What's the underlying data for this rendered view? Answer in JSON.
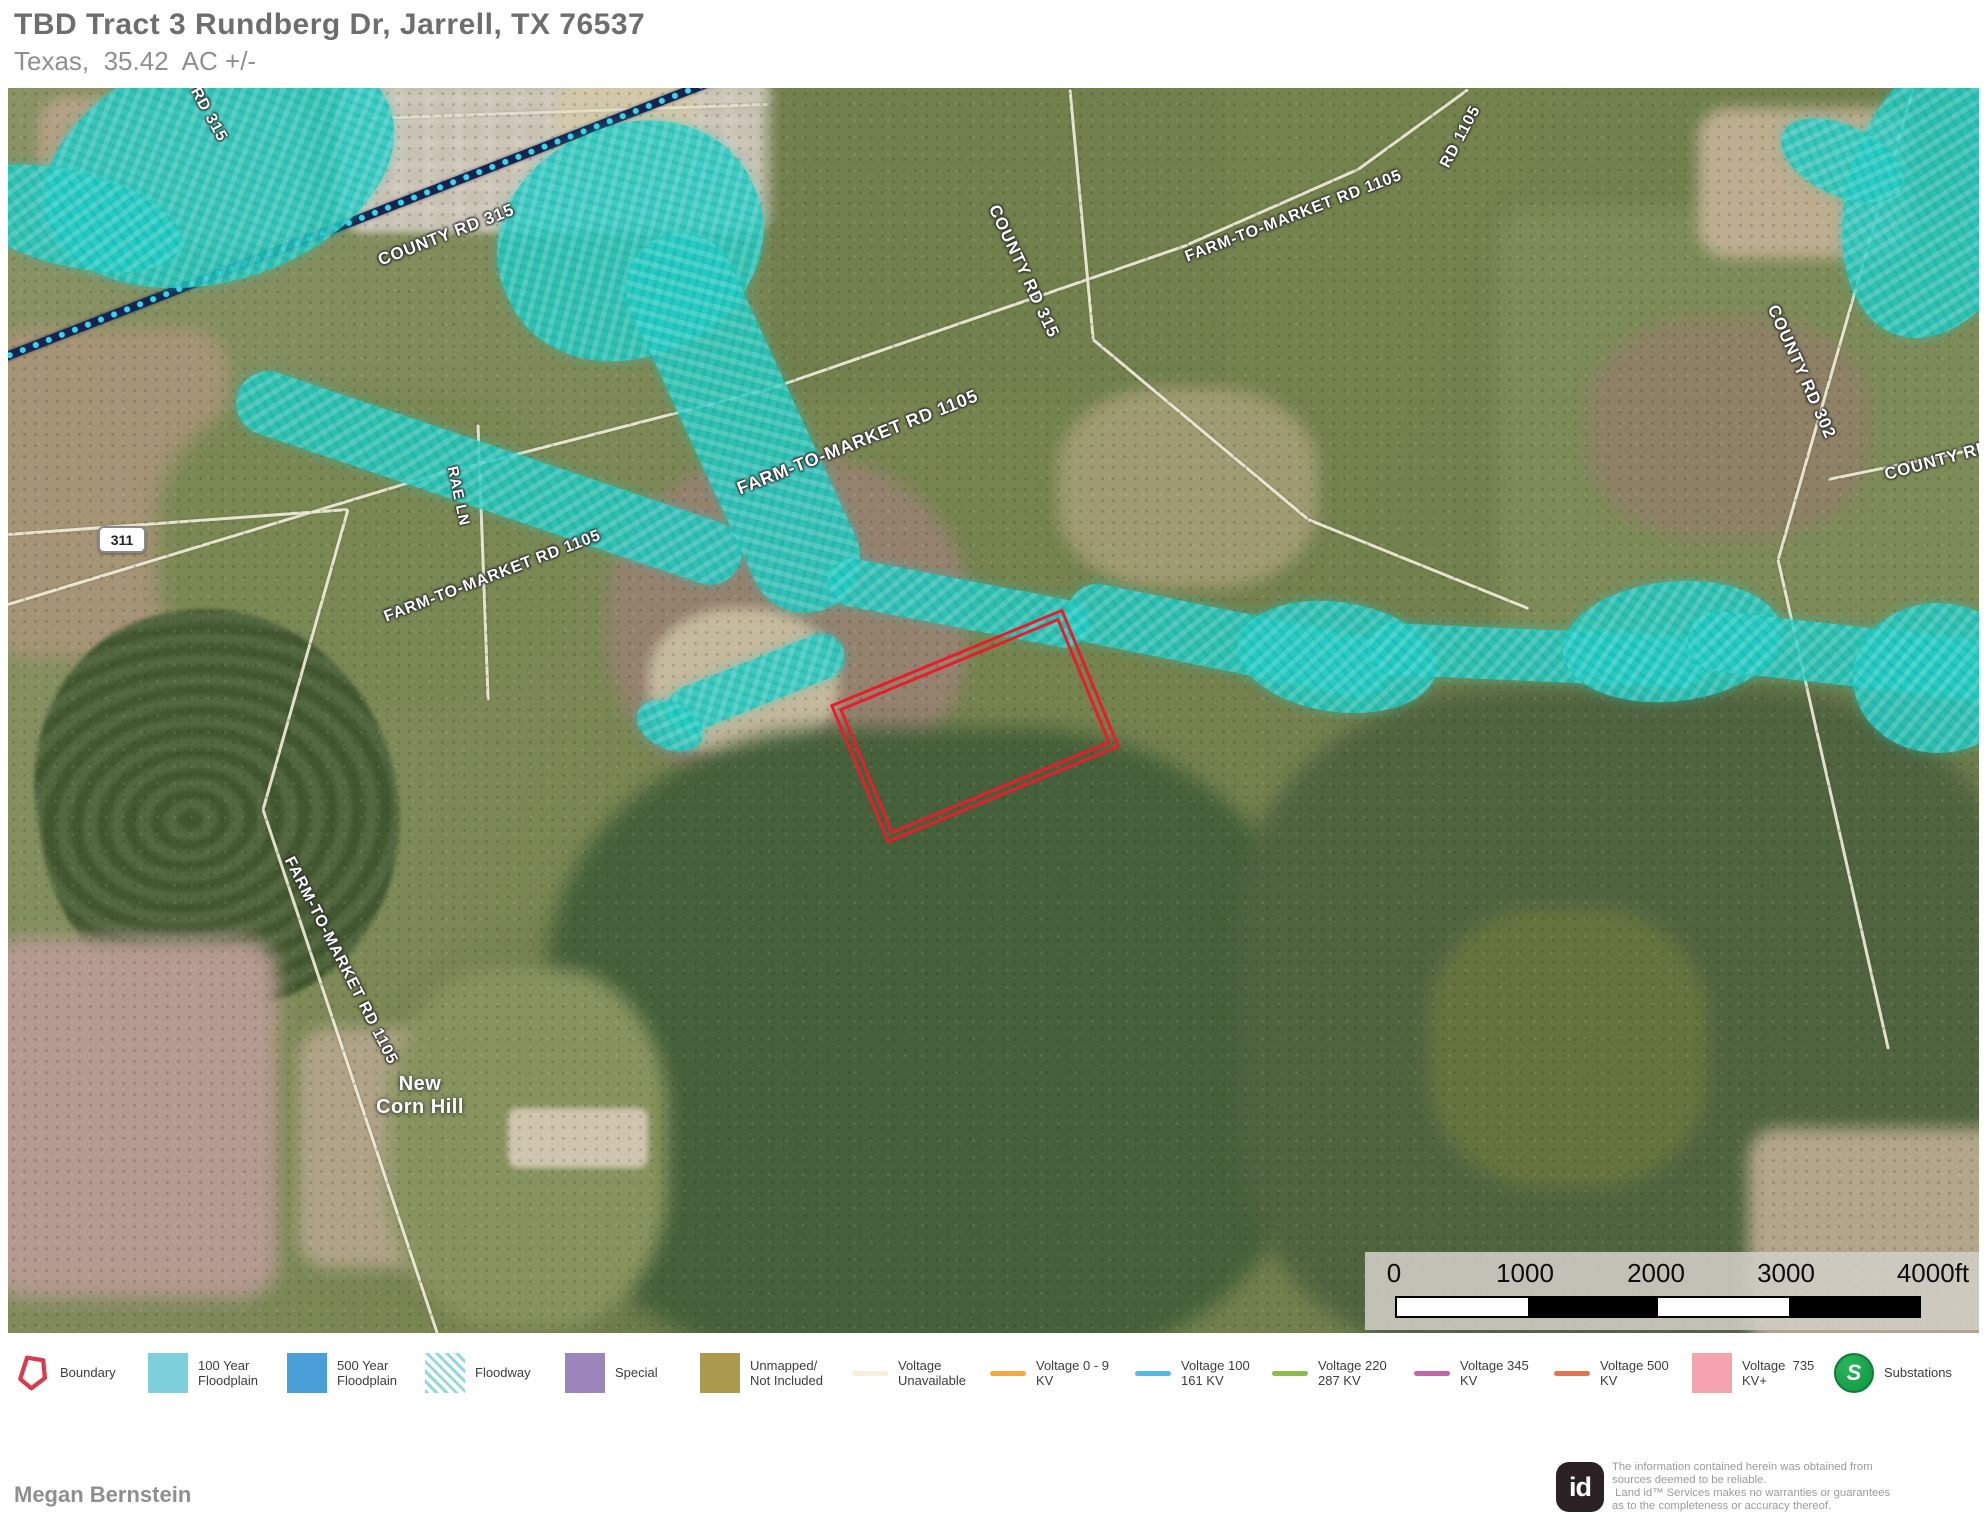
{
  "header": {
    "title": "TBD Tract 3 Rundberg Dr, Jarrell, TX 76537",
    "subtitle": "Texas,  35.42  AC +/-"
  },
  "map": {
    "labels": [
      {
        "t": "RD 315",
        "x": 186,
        "y": -8,
        "r": 61,
        "s": 16
      },
      {
        "t": "COUNTY RD 315",
        "x": 371,
        "y": 163,
        "r": -21,
        "s": 17
      },
      {
        "t": "COUNTY RD 315",
        "x": 985,
        "y": 108,
        "r": 65,
        "s": 17
      },
      {
        "t": "FARM-TO-MARKET RD 1105",
        "x": 1178,
        "y": 161,
        "r": -21,
        "s": 16
      },
      {
        "t": "RD 1105",
        "x": 1437,
        "y": 70,
        "r": -62,
        "s": 16
      },
      {
        "t": "FARM-TO-MARKET RD 1105",
        "x": 730,
        "y": 391,
        "r": -21.5,
        "s": 18
      },
      {
        "t": "FARM-TO-MARKET RD 1105",
        "x": 377,
        "y": 521,
        "r": -21,
        "s": 16
      },
      {
        "t": "RAE LN",
        "x": 444,
        "y": 370,
        "r": 78,
        "s": 15
      },
      {
        "t": "COUNTY RD 302",
        "x": 1764,
        "y": 208,
        "r": 66,
        "s": 17
      },
      {
        "t": "COUNTY RD 3",
        "x": 1877,
        "y": 377,
        "r": -15,
        "s": 17
      },
      {
        "t": "FARM-TO-MARKET RD 1105",
        "x": 280,
        "y": 761,
        "r": 63,
        "s": 16
      },
      {
        "t": "New\nCorn Hill",
        "x": 352,
        "y": 985,
        "r": 0,
        "s": 20,
        "cls": "place"
      },
      {
        "t": "311",
        "x": 90,
        "y": 438,
        "cls": "badge"
      }
    ]
  },
  "scalebar": {
    "ticks": [
      {
        "t": "0",
        "x": 29
      },
      {
        "t": "1000",
        "x": 160
      },
      {
        "t": "2000",
        "x": 291
      },
      {
        "t": "3000",
        "x": 421
      },
      {
        "t": "4000ft",
        "x": 568
      }
    ]
  },
  "legend": {
    "items": [
      {
        "id": "boundary",
        "x": 16,
        "label": "Boundary",
        "swatch": "boundary",
        "color": "#d93a4c"
      },
      {
        "id": "floodplain-100",
        "x": 148,
        "label": "100 Year\nFloodplain",
        "swatch": "square",
        "color": "#7ed0dc"
      },
      {
        "id": "floodplain-500",
        "x": 287,
        "label": "500 Year\nFloodplain",
        "swatch": "square",
        "color": "#4b9fd8"
      },
      {
        "id": "floodway",
        "x": 425,
        "label": "Floodway",
        "swatch": "hatch",
        "color": "#8ed4de"
      },
      {
        "id": "special",
        "x": 565,
        "label": "Special",
        "swatch": "square",
        "color": "#9c85bb"
      },
      {
        "id": "unmapped",
        "x": 700,
        "label": "Unmapped/\nNot Included",
        "swatch": "square",
        "color": "#ab9a4d"
      },
      {
        "id": "voltage-unavailable",
        "x": 852,
        "label": "Voltage\nUnavailable",
        "swatch": "line",
        "color": "#f4f0da"
      },
      {
        "id": "voltage-0-9",
        "x": 990,
        "label": "Voltage 0 - 9\nKV",
        "swatch": "line",
        "color": "#f2a93e"
      },
      {
        "id": "voltage-100-161",
        "x": 1135,
        "label": "Voltage 100\n161 KV",
        "swatch": "line",
        "color": "#55b9e8"
      },
      {
        "id": "voltage-220-287",
        "x": 1272,
        "label": "Voltage 220\n287 KV",
        "swatch": "line",
        "color": "#8dbb4d"
      },
      {
        "id": "voltage-345",
        "x": 1414,
        "label": "Voltage 345\nKV",
        "swatch": "line",
        "color": "#c464a9"
      },
      {
        "id": "voltage-500",
        "x": 1554,
        "label": "Voltage 500\nKV",
        "swatch": "line",
        "color": "#e2744e"
      },
      {
        "id": "voltage-735",
        "x": 1692,
        "label": "Voltage  735\nKV+",
        "swatch": "square",
        "color": "#f5a3ae"
      },
      {
        "id": "substations",
        "x": 1834,
        "label": "Substations",
        "swatch": "substation",
        "color": "#13a14b",
        "icon_letter": "S"
      }
    ]
  },
  "footer": {
    "agent": "Megan Bernstein",
    "logo_text": "id",
    "disclaimer_lines": [
      "The information contained herein was obtained from",
      "sources deemed to be reliable.",
      " Land id™ Services makes no warranties or guarantees",
      "as to the completeness or accuracy thereof."
    ]
  }
}
